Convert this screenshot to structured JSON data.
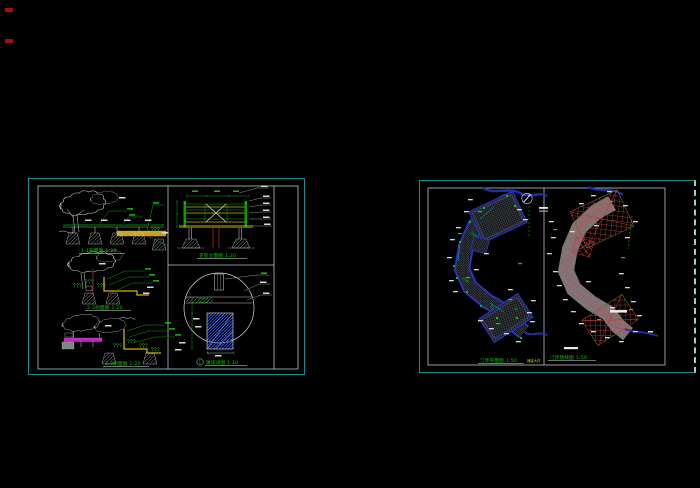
{
  "app": {
    "background": "#000000",
    "description": "CAD viewport with two drawing sheets"
  },
  "colors": {
    "panel_border": "#1a8c94",
    "inner_border": "#b7c6c9",
    "annotation_green": "#00d400",
    "dimension_white": "#e0e0e0",
    "path_blue": "#2a35c8",
    "grid_red": "#c24a4a",
    "stream_blue": "#1f2fb0",
    "wood_yellow": "#d4b020",
    "bench_magenta": "#c238c2",
    "detail_red": "#b42a2a"
  },
  "left_sheet": {
    "sections": [
      {
        "title": "1-1剖面图",
        "scale": "1:20"
      },
      {
        "title": "2-2剖面图",
        "scale": "1:20"
      },
      {
        "title": "3-3剖面图",
        "scale": "1:20"
      }
    ],
    "elevation": {
      "title": "花架立面图",
      "scale": "1:20"
    },
    "detail": {
      "badge": "1",
      "title": "做法详图",
      "scale": "1:10"
    }
  },
  "right_sheet": {
    "plan": {
      "title": "汀步平面图",
      "scale": "1:50",
      "note": "铺装大样"
    },
    "layout": {
      "title": "汀步放线图",
      "scale": "1:50"
    }
  }
}
